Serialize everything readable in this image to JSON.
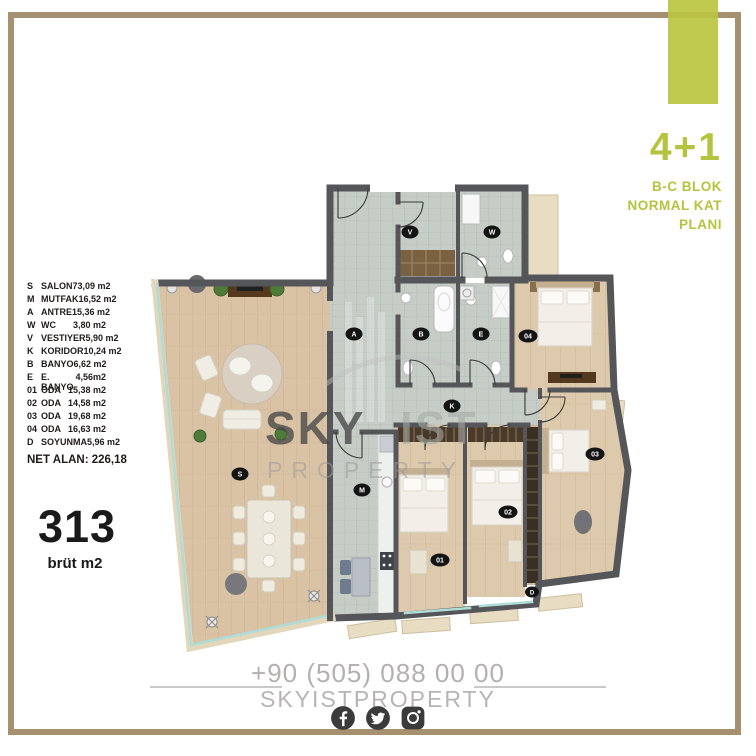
{
  "brand": {
    "accent_color": "#bac63f",
    "frame_color": "#a5916f"
  },
  "unit": {
    "type": "4+1",
    "block_line1": "B-C BLOK",
    "block_line2": "NORMAL KAT",
    "block_line3": "PLANI"
  },
  "legend": {
    "rows": [
      {
        "code": "S",
        "name": "SALON",
        "area": "73,09 m2"
      },
      {
        "code": "M",
        "name": "MUTFAK",
        "area": "16,52 m2"
      },
      {
        "code": "A",
        "name": "ANTRE",
        "area": "15,36 m2"
      },
      {
        "code": "W",
        "name": "WC",
        "area": "3,80 m2"
      },
      {
        "code": "V",
        "name": "VESTIYER",
        "area": "5,90 m2"
      },
      {
        "code": "K",
        "name": "KORIDOR",
        "area": "10,24 m2"
      },
      {
        "code": "B",
        "name": "BANYO",
        "area": "6,62 m2"
      },
      {
        "code": "E",
        "name": "E. BANYO",
        "area": "4,56m2"
      },
      {
        "code": "01",
        "name": "ODA",
        "area": "15,38 m2"
      },
      {
        "code": "02",
        "name": "ODA",
        "area": "14,58 m2"
      },
      {
        "code": "03",
        "name": "ODA",
        "area": "19,68 m2"
      },
      {
        "code": "04",
        "name": "ODA",
        "area": "16,63 m2"
      },
      {
        "code": "D",
        "name": "SOYUNMA",
        "area": "5,96 m2"
      }
    ],
    "net_area": "NET ALAN: 226,18"
  },
  "gross": {
    "value": "313",
    "unit": "brüt m2"
  },
  "plan": {
    "labels": {
      "salon": "S",
      "mutfak": "M",
      "antre": "A",
      "wc": "W",
      "vestiyer": "V",
      "koridor": "K",
      "banyo": "B",
      "ebanyo": "E",
      "oda1": "01",
      "oda2": "02",
      "oda3": "03",
      "oda4": "04",
      "soyunma": "D"
    }
  },
  "watermark": {
    "word1": "SKY",
    "word2": "IST",
    "word3": "PROPERTY"
  },
  "footer": {
    "phone": "+90 (505) 088 00 00",
    "brand": "SKYISTPROPERTY",
    "icons": [
      "facebook",
      "twitter",
      "instagram"
    ]
  }
}
